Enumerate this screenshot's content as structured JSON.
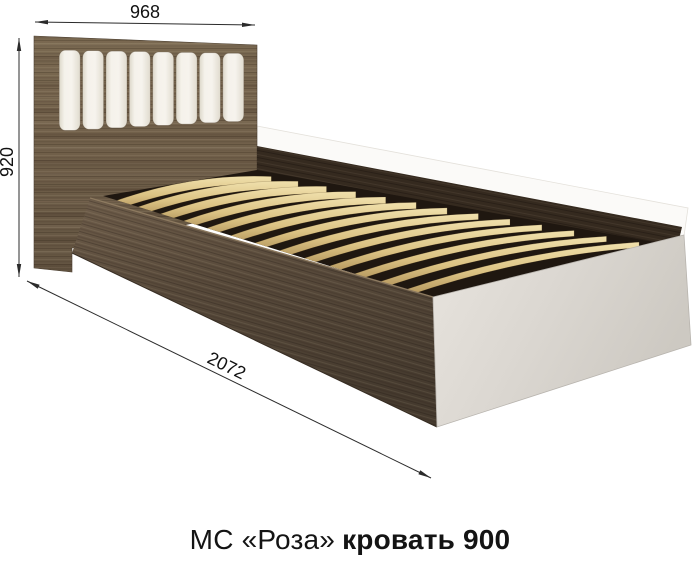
{
  "caption": {
    "regular": "МС «Роза»",
    "bold": "кровать 900",
    "full_text": "МС «Роза» кровать 900"
  },
  "dimensions": {
    "width_mm": "968",
    "height_mm": "920",
    "length_mm": "2072"
  },
  "bed": {
    "slat_count": 13,
    "cushion_count": 8
  },
  "colors": {
    "headboard_wood": "#75644e",
    "headboard_wood_dark": "#5f5040",
    "front_rail_top": "#6e5d4a",
    "front_rail_mid": "#564839",
    "front_rail_bottom": "#46392d",
    "far_rail_band": "#352a1f",
    "deck_dark": "#1f1710",
    "slat_light": "#f0e0ac",
    "slat_mid": "#dcc384",
    "slat_shadow": "#b3955c",
    "footboard_light": "#e6e2dc",
    "footboard_dark": "#cfcbc4",
    "footboard_edge": "#b8b4ae",
    "cushion_center": "#f5f2eb",
    "cushion_edge": "#dcd7c9",
    "faint_outline": "#e4e1db",
    "dim_line": "#2b2b2b",
    "dim_text": "#111111"
  }
}
